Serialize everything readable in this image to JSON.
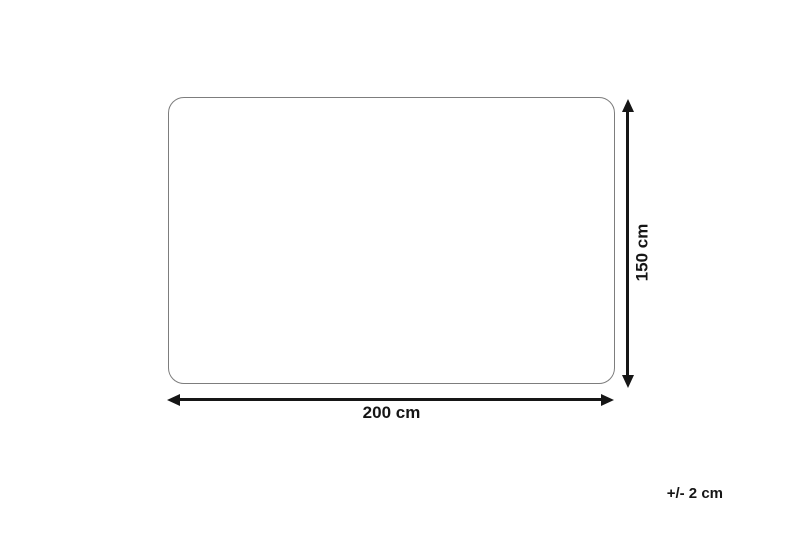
{
  "diagram": {
    "width_label": "200 cm",
    "height_label": "150 cm",
    "tolerance_label": "+/- 2 cm",
    "colors": {
      "background": "#ffffff",
      "outline": "#7d7d7d",
      "arrow": "#161616",
      "text": "#161616"
    }
  }
}
